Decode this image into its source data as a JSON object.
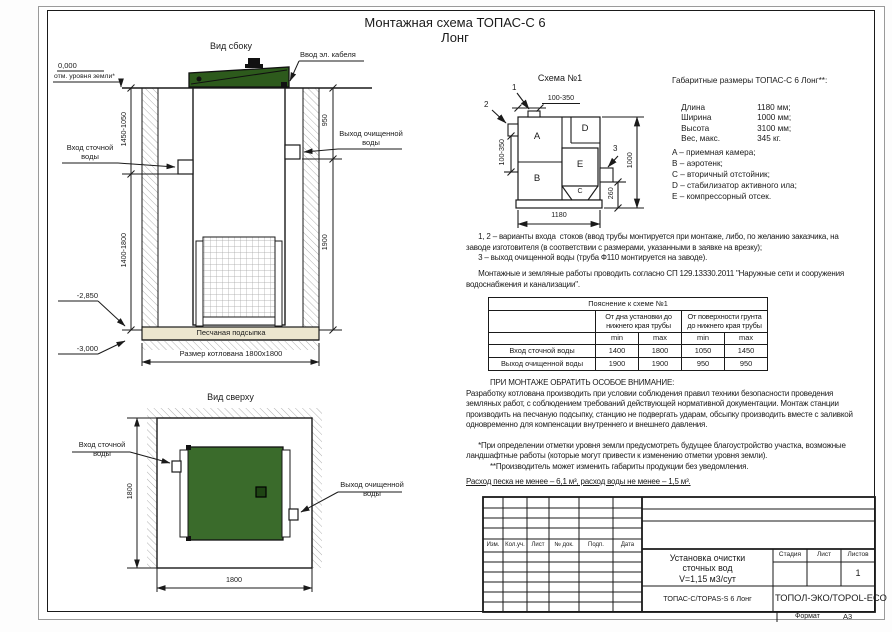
{
  "colors": {
    "lid_green": "#2d5a1c",
    "station_green": "#3a6b2b",
    "inner_square_green": "#1e4413",
    "sand": "#ece6cf"
  },
  "sheet": {
    "title_line1": "Монтажная схема ТОПАС-С 6",
    "title_line2": "Лонг",
    "format_label": "Формат",
    "format_value": "А3"
  },
  "side_view": {
    "label": "Вид сбоку",
    "cable_entry": "Ввод эл. кабеля",
    "level_zero": "0,000",
    "level_zero_note": "отм. уровня земли*",
    "level_bottom_unit": "-2,850",
    "level_pit": "-3,000",
    "dim_left_top": "1450-1050",
    "dim_left_bottom": "1400-1800",
    "dim_right_top": "950",
    "dim_right_bottom": "1900",
    "inlet_label": "Вход сточной\nводы",
    "outlet_label": "Выход очищенной\nводы",
    "sand_label": "Песчаная подсыпка",
    "pit_dim": "Размер котлована 1800x1800"
  },
  "top_view": {
    "label": "Вид сверху",
    "inlet_label": "Вход сточной\nводы",
    "outlet_label": "Выход очищенной\nводы",
    "dim_left": "1800",
    "dim_bottom": "1800"
  },
  "schema": {
    "label": "Схема №1",
    "callout_1": "1",
    "callout_2": "2",
    "callout_3": "3",
    "dim_top": "100-350",
    "dim_left": "100-350",
    "dim_right_outer": "1000",
    "dim_right_inner": "260",
    "dim_bottom": "1180",
    "compartments": {
      "a": "A",
      "b": "B",
      "c": "C",
      "d": "D",
      "e": "E"
    }
  },
  "gabarit": {
    "title": "Габаритные размеры ТОПАС-С 6 Лонг**:",
    "rows": [
      {
        "label": "Длина",
        "value": "1180 мм;"
      },
      {
        "label": "Ширина",
        "value": "1000 мм;"
      },
      {
        "label": "Высота",
        "value": "3100 мм;"
      },
      {
        "label": "Вес, макс.",
        "value": "345 кг."
      }
    ],
    "legend": [
      "A – приемная камера;",
      "B – аэротенк;",
      "C – вторичный отстойник;",
      "D – стабилизатор активного ила;",
      "E – компрессорный отсек."
    ]
  },
  "notes": {
    "para1": "      1, 2 – варианты входа  стоков (ввод трубы монтируется при монтаже, либо, по желанию заказчика, на\nзаводе изготовителя (в соответствии с размерами, указанными в заявке на врезку);\n      3 – выход очищенной воды (труба Ф110 монтируется на заводе).",
    "para2": "      Монтажные и земляные работы проводить согласно СП 129.13330.2011 \"Наружные сети и сооружения\nводоснабжения и канализации\"."
  },
  "explain_table": {
    "caption": "Пояснение к схеме №1",
    "col_group_1": "От дна установки до\nнижнего края трубы",
    "col_group_2": "От поверхности грунта\nдо нижнего края трубы",
    "min_label": "min",
    "max_label": "max",
    "rows": [
      {
        "name": "Вход сточной воды",
        "values": [
          "1400",
          "1800",
          "1050",
          "1450"
        ]
      },
      {
        "name": "Выход очищенной воды",
        "values": [
          "1900",
          "1900",
          "950",
          "950"
        ]
      }
    ]
  },
  "attention": {
    "heading": "ПРИ МОНТАЖЕ ОБРАТИТЬ ОСОБОЕ ВНИМАНИЕ:",
    "body": "Разработку котлована производить при условии соблюдения правил техники безопасности проведения\nземляных работ, с соблюдением требований действующей нормативной документации. Монтаж станции\nпроизводить на песчаную подсыпку, станцию не подвергать ударам, обсыпку производить вместе с заливкой\nодновременно для компенсации внутреннего и внешнего давления.",
    "footnote1": "      *При определении отметки уровня земли предусмотреть будущее благоустройство участка, возможные\nландшафтные работы (которые могут привести к изменению отметки уровня земли).",
    "footnote2": "**Производитель может изменить габариты продукции без уведомления.",
    "consumption": "Расход песка не менее – 6,1 м³, расход воды не менее – 1,5 м³."
  },
  "titleblock": {
    "rev_cols": [
      "Изм.",
      "Кол.уч.",
      "Лист",
      "№ док.",
      "Подп.",
      "Дата"
    ],
    "doc_title": "Установка очистки\nсточных вод\nV=1,15 м3/сут",
    "stage_label": "Стадия",
    "sheet_label": "Лист",
    "sheets_label": "Листов",
    "sheets_value": "1",
    "model": "ТОПАС-С/TOPAS-S 6 Лонг",
    "company": "ТОПОЛ-ЭКО/TOPOL-ECO"
  }
}
